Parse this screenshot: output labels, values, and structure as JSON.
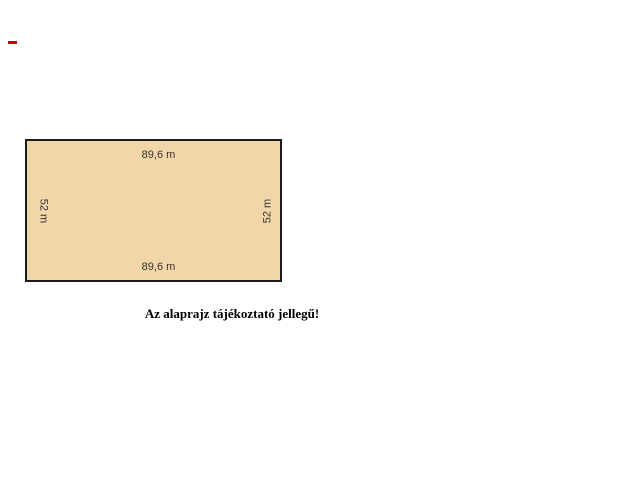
{
  "page": {
    "background_color": "#ffffff"
  },
  "marker": {
    "color": "#cc0000"
  },
  "floorplan": {
    "fill_color": "#f1d6a8",
    "border_color": "#1a1a1a",
    "labels": {
      "top": "89,6 m",
      "bottom": "89,6 m",
      "left": "52 m",
      "right": "52 m"
    }
  },
  "caption": {
    "text": "Az alaprajz tájékoztató jellegű!"
  }
}
